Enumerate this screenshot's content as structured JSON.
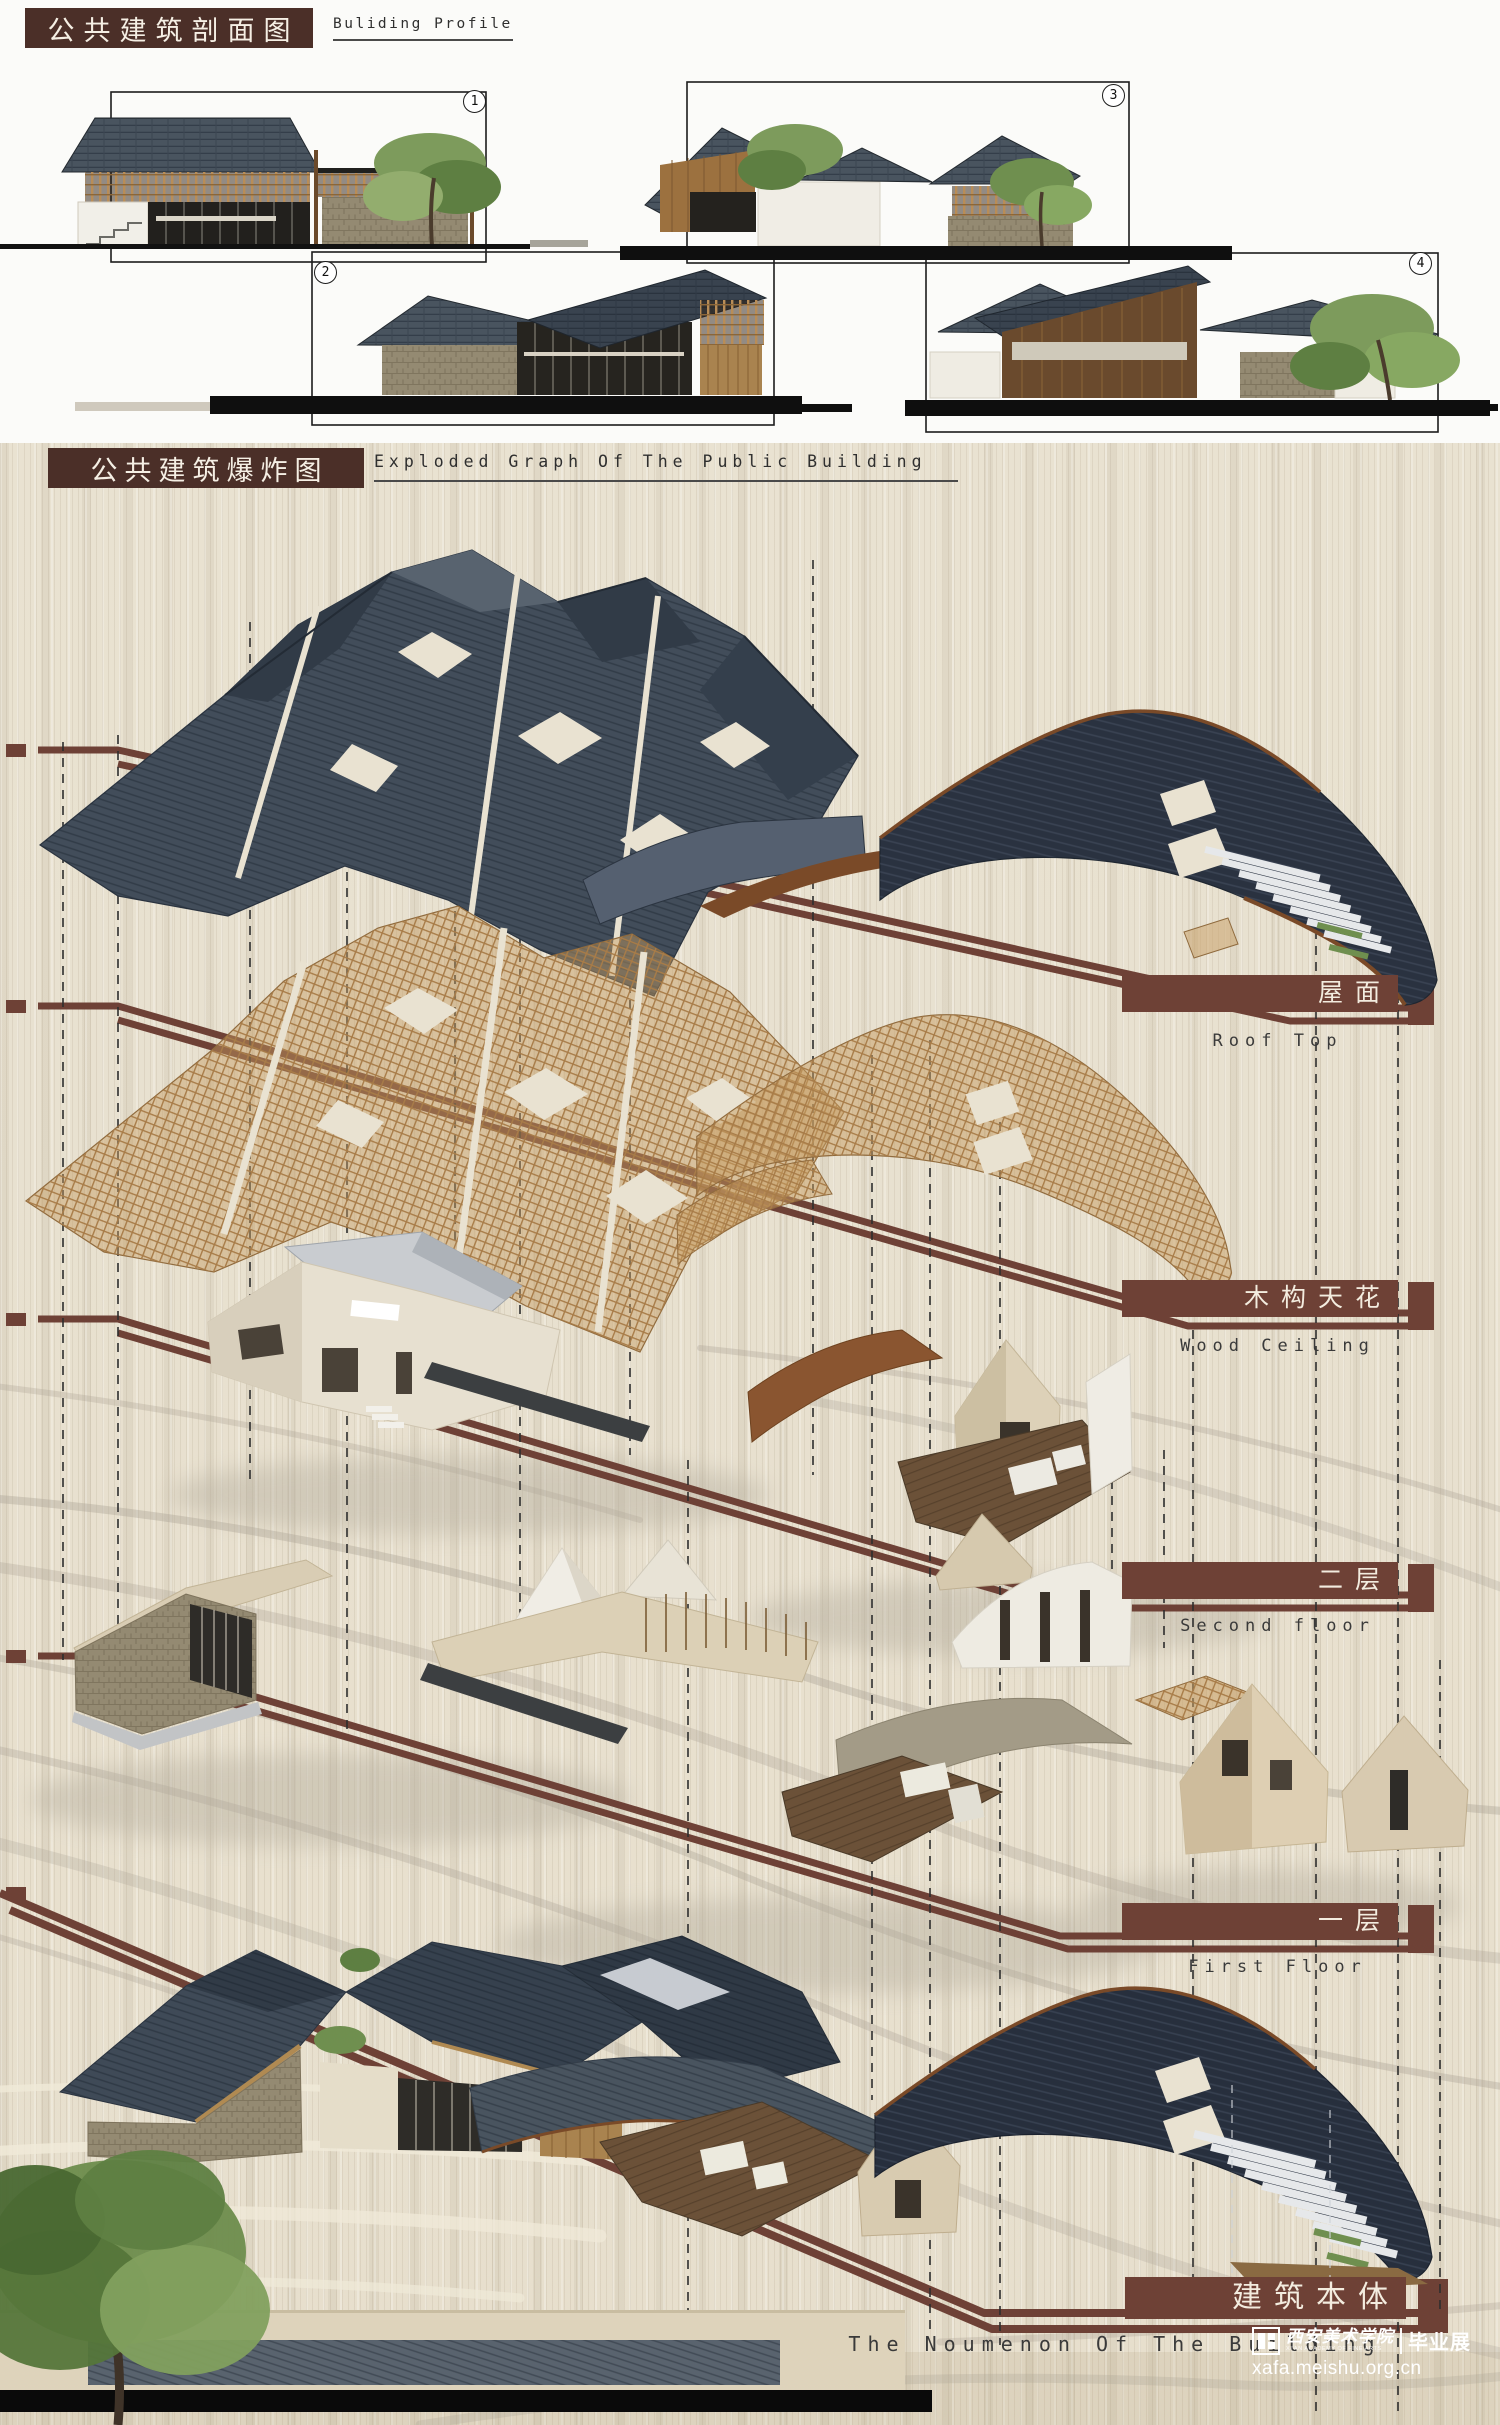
{
  "sections": {
    "profile": {
      "title_cn": "公共建筑剖面图",
      "title_en": "Buliding Profile",
      "figures": [
        "1",
        "2",
        "3",
        "4"
      ]
    },
    "exploded": {
      "title_cn": "公共建筑爆炸图",
      "title_en": "Exploded Graph Of The Public Building"
    }
  },
  "layer_labels": [
    {
      "cn": "屋面",
      "en": "Roof Top"
    },
    {
      "cn": "木构天花",
      "en": "Wood Ceiling"
    },
    {
      "cn": "二层",
      "en": "Second floor"
    },
    {
      "cn": "一层",
      "en": "First Floor"
    },
    {
      "cn": "建筑本体",
      "en": "The Noumenon Of The Building"
    }
  ],
  "watermark": {
    "school_cn": "西安美术学院",
    "school_en": "XI'AN ACADEMY OF FINE ARTS",
    "badge": "毕业展",
    "url": "xafa.meishu.org.cn"
  },
  "colors": {
    "title_brown": "#4B2F28",
    "accent_brown": "#6E4136",
    "slate_roof": "#424D5A",
    "navy_roof": "#2A3240",
    "wood_tan": "#B68950",
    "panel_background": "#E9E2D1"
  }
}
